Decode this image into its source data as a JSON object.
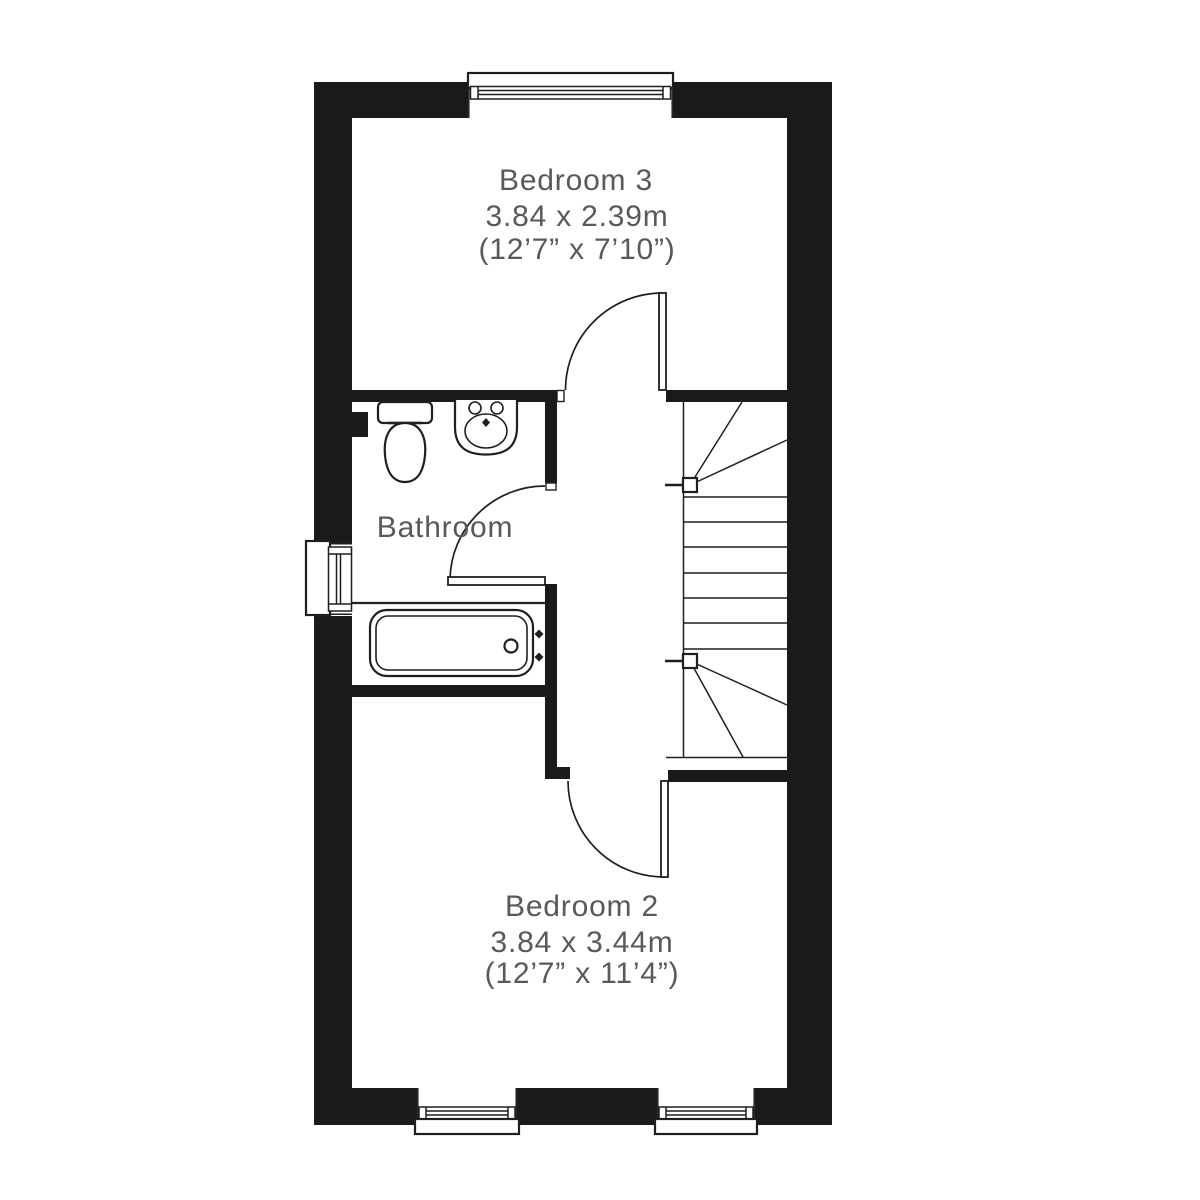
{
  "floorplan": {
    "colors": {
      "wall": "#1a1a1a",
      "line": "#1f1f1f",
      "label": "#58595b",
      "bg": "#ffffff"
    },
    "rooms": [
      {
        "id": "bedroom-3",
        "name": "Bedroom 3",
        "size_metric": "3.84 x 2.39m",
        "size_imperial": "(12’7” x 7’10”)"
      },
      {
        "id": "bathroom",
        "name": "Bathroom",
        "size_metric": "",
        "size_imperial": ""
      },
      {
        "id": "bedroom-2",
        "name": "Bedroom 2",
        "size_metric": "3.84 x 3.44m",
        "size_imperial": "(12’7” x 11’4”)"
      }
    ],
    "fixtures": [
      "toilet",
      "basin",
      "bathtub",
      "staircase"
    ],
    "doors": [
      "bedroom-3-door",
      "bathroom-door",
      "bedroom-2-door"
    ],
    "windows": [
      "top-window",
      "left-window",
      "bottom-left-window",
      "bottom-right-window"
    ]
  }
}
